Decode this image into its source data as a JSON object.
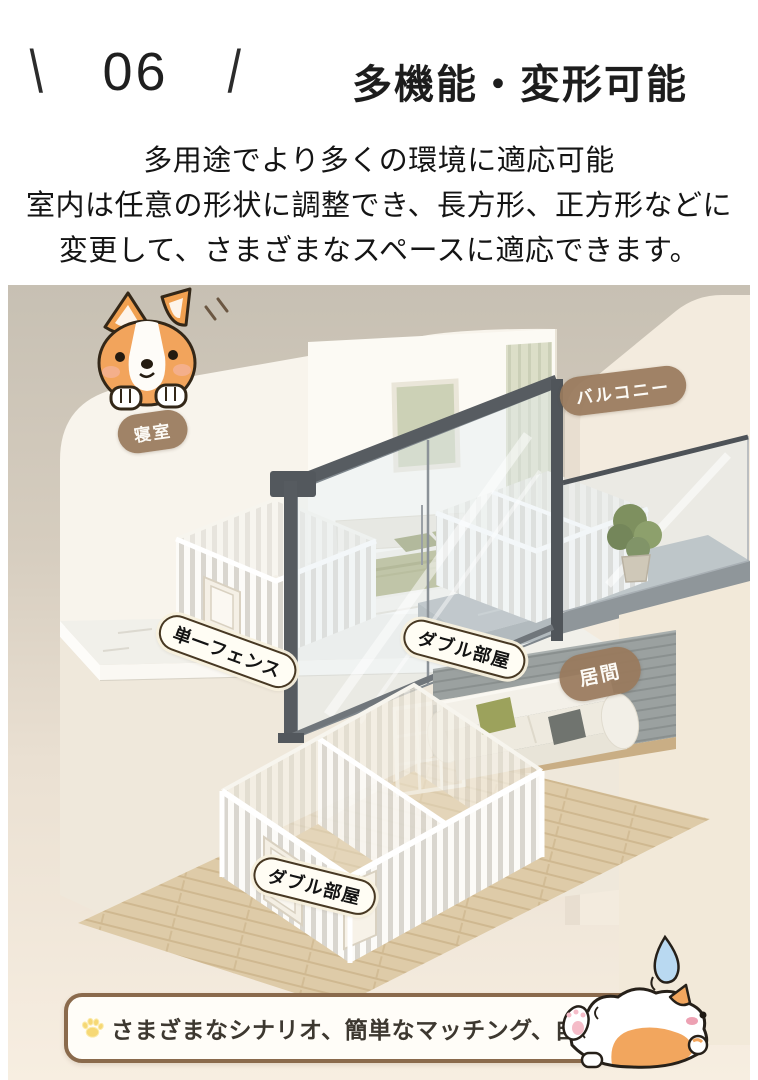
{
  "header": {
    "slash_left": "\\",
    "number": "06",
    "slash_right": "/",
    "title": "多機能・変形可能"
  },
  "description": {
    "line1": "多用途でより多くの環境に適応可能",
    "line2": "室内は任意の形状に調整でき、長方形、正方形などに",
    "line3": "変更して、さまざまなスペースに適応できます。"
  },
  "illustration": {
    "labels": {
      "bedroom": "寝室",
      "balcony": "バルコニー",
      "single_fence": "単一フェンス",
      "double_room_upper": "ダブル部屋",
      "living_room": "居間",
      "double_room_lower": "ダブル部屋"
    },
    "icons": {
      "corgi_peeking": "corgi-peeking-illustration",
      "corgi_lying": "corgi-lying-illustration",
      "sweat_drop": "sweat-drop-icon",
      "paw": "paw-icon"
    }
  },
  "banner": {
    "text": "さまざまなシナリオ、簡単なマッチング、自由な拡張"
  },
  "colors": {
    "label_pill_brown": "#9a7b5d",
    "white_pill_border": "#473823",
    "banner_border": "#8a6a4c",
    "paw_yellow": "#f6d76e",
    "corgi_orange": "#f2a65e",
    "bed_sage": "#a8aa74",
    "background_top": "#c7c0b3",
    "background_bottom": "#f7eee1"
  }
}
